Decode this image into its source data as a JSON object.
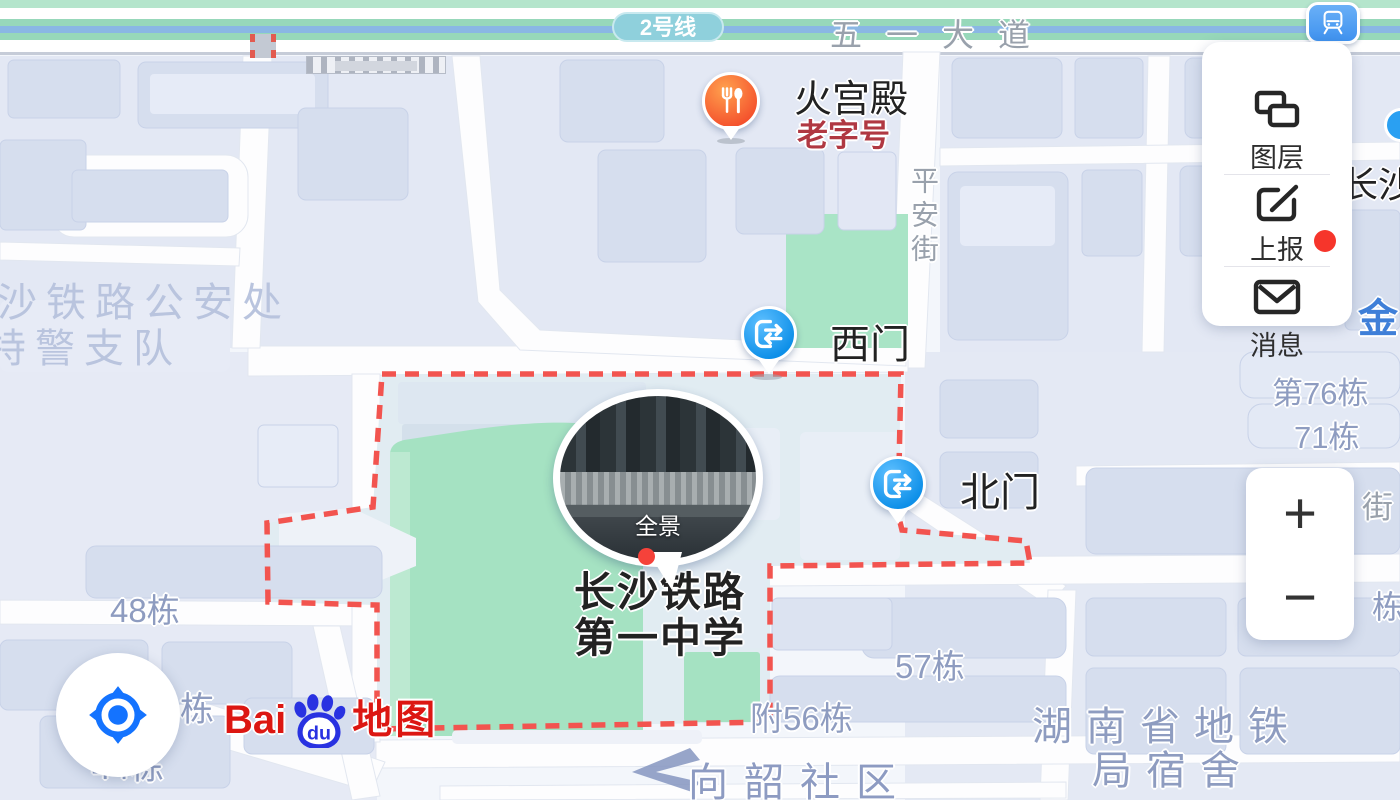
{
  "transit": {
    "line_badge": "2号线"
  },
  "streets": {
    "wuyi_avenue": "五一大道",
    "pingan_street": "平安街",
    "jie_partial": "街"
  },
  "pois": {
    "restaurant": {
      "name": "火宫殿",
      "tag": "老字号"
    },
    "west_gate": {
      "name": "西门"
    },
    "north_gate": {
      "name": "北门"
    },
    "school": {
      "name_line1": "长沙铁路",
      "name_line2": "第一中学"
    },
    "panorama": {
      "label": "全景"
    },
    "police": {
      "line1": "长沙铁路公安处",
      "line2": "特警支队"
    },
    "community": {
      "name": "向韶社区"
    },
    "dorm": {
      "line1": "湖南省地铁",
      "line2": "局宿舍"
    },
    "jin_partial": "金",
    "changsha_partial": "长沙"
  },
  "buildings": {
    "b48": "48栋",
    "b44": "44栋",
    "b45_partial": "栋",
    "b57": "57栋",
    "b56": "附56栋",
    "b76": "第76栋",
    "b71": "71栋",
    "dong_partial": "栋"
  },
  "controls": {
    "layers": "图层",
    "report": "上报",
    "messages": "消息",
    "messages_has_unread": true,
    "zoom_in": "+",
    "zoom_out": "−"
  },
  "logo": {
    "bai": "Bai",
    "du": "du",
    "word": "地图"
  },
  "colors": {
    "boundary_red": "#f2544f",
    "gate_blue": "#149bf1",
    "restaurant_orange": "#f85f2e",
    "metro_line_blue": "#8ab7e4",
    "greenery": "#a5e2c2",
    "label_blue_gray": "#8e9cc0",
    "notification_red": "#f6352b",
    "baidu_red": "#dc1712",
    "baidu_blue": "#2932e1"
  }
}
